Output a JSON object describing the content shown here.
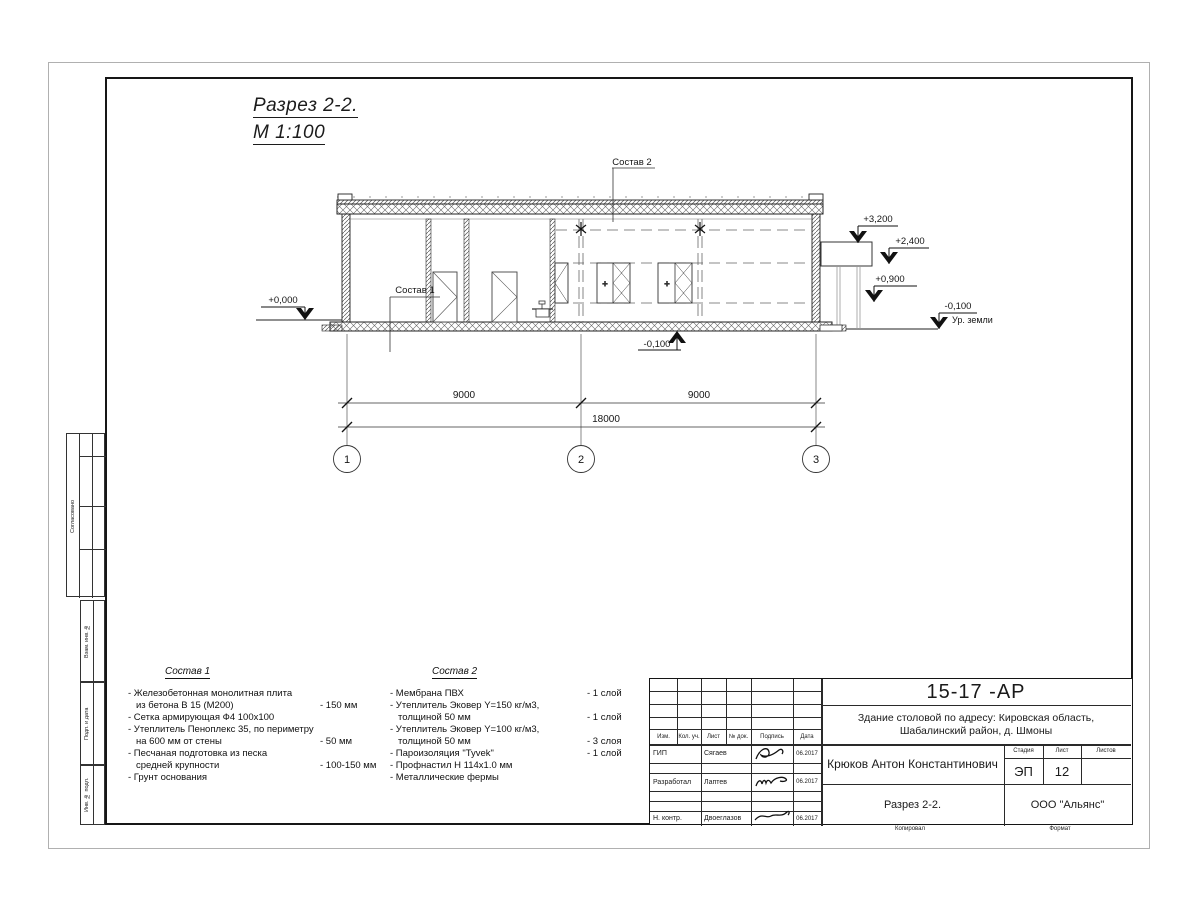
{
  "drawing": {
    "title_line1": "Разрез 2-2.",
    "title_line2": "М 1:100",
    "labels": {
      "sostav1_leader": "Состав 1",
      "sostav2_leader": "Состав 2",
      "ground": "Ур. земли",
      "window_plus": "+"
    },
    "elevations": {
      "zero": "+0,000",
      "e3200": "+3,200",
      "e2400": "+2,400",
      "e0900": "+0,900",
      "minus0100_right": "-0,100",
      "minus0100_bottom": "-0,100"
    },
    "dimensions": {
      "left": "9000",
      "right": "9000",
      "total": "18000"
    },
    "axes": {
      "a1": "1",
      "a2": "2",
      "a3": "3"
    }
  },
  "sostav1": {
    "header": "Состав 1",
    "items": [
      {
        "text": "- Железобетонная  монолитная плита",
        "value": ""
      },
      {
        "text": "из бетона В 15 (М200)",
        "value": "- 150 мм"
      },
      {
        "text": "- Сетка армирующая Ф4 100х100",
        "value": ""
      },
      {
        "text": "- Утеплитель Пеноплекс 35, по периметру",
        "value": ""
      },
      {
        "text": "на 600 мм от стены",
        "value": "- 50 мм"
      },
      {
        "text": "- Песчаная подготовка из песка",
        "value": ""
      },
      {
        "text": "средней крупности",
        "value": "- 100-150 мм"
      },
      {
        "text": "- Грунт основания",
        "value": ""
      }
    ]
  },
  "sostav2": {
    "header": "Состав 2",
    "items": [
      {
        "text": "- Мембрана ПВХ",
        "value": "- 1 слой"
      },
      {
        "text": "- Утеплитель Эковер Y=150 кг/м3,",
        "value": ""
      },
      {
        "text": "толщиной 50 мм",
        "value": "- 1 слой"
      },
      {
        "text": "- Утеплитель Эковер Y=100 кг/м3,",
        "value": ""
      },
      {
        "text": "толщиной 50 мм",
        "value": "- 3 слоя"
      },
      {
        "text": "- Пароизоляция \"Tyvek\"",
        "value": "- 1 слой"
      },
      {
        "text": "- Профнастил Н 114х1.0 мм",
        "value": ""
      },
      {
        "text": "- Металлические фермы",
        "value": ""
      }
    ]
  },
  "titleblock": {
    "doc_number": "15-17 -АР",
    "project_line1": "Здание столовой по адресу: Кировская область,",
    "project_line2": "Шабалинский район, д. Шмоны",
    "chief_name": "Крюков Антон Константинович",
    "sheet_title": "Разрез 2-2.",
    "company": "ООО \"Альянс\"",
    "stage_label": "Стадия",
    "sheet_label": "Лист",
    "sheets_label": "Листов",
    "stage": "ЭП",
    "sheet": "12",
    "sheets": "",
    "cols": {
      "izm": "Изм.",
      "kol": "Кол. уч.",
      "list": "Лист",
      "doc": "№ док.",
      "sign": "Подпись",
      "date": "Дата"
    },
    "rows": [
      {
        "role": "ГИП",
        "name": "Сягаев",
        "date": "06.2017"
      },
      {
        "role": "Разработал",
        "name": "Лаптев",
        "date": "06.2017"
      },
      {
        "role": "Н. контр.",
        "name": "Двоеглазов",
        "date": "06.2017"
      }
    ],
    "footer": {
      "kopiroval": "Копировал",
      "format": "Формат"
    }
  },
  "margin_labels": {
    "soglasovano": "Согласовано",
    "vzam": "Взам. инв. №",
    "podp": "Подп. и дата",
    "inv": "Инв. № подл."
  }
}
